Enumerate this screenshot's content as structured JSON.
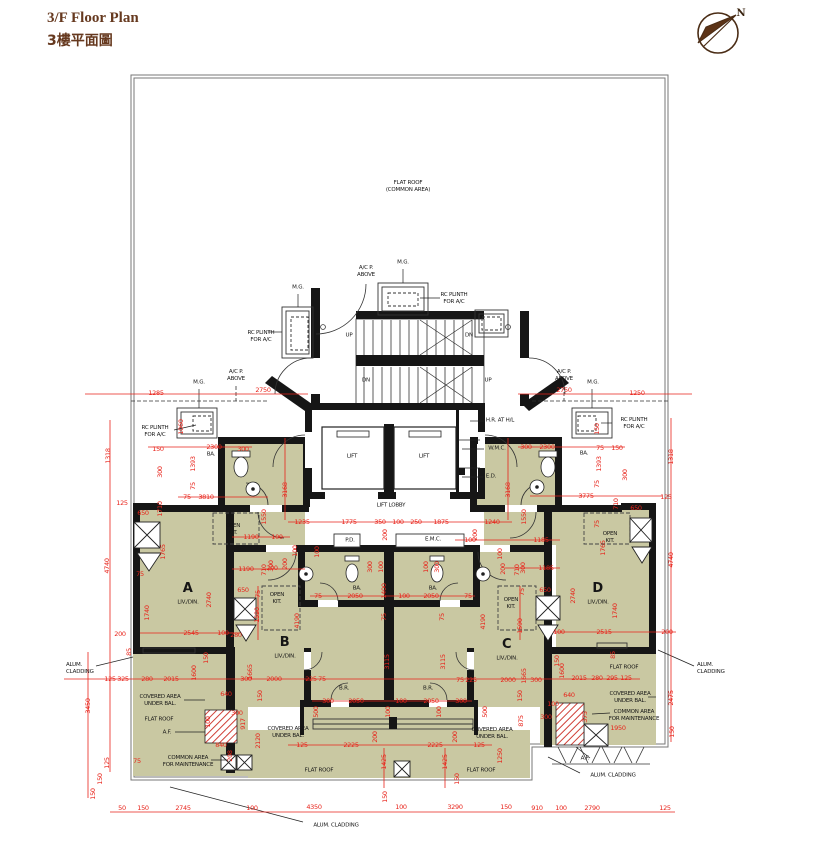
{
  "title": {
    "line1": "3/F Floor Plan",
    "line2": "3樓平面圖"
  },
  "compass": {
    "label": "N"
  },
  "colors": {
    "flat_fill": "#c9c8a2",
    "wall": "#161616",
    "dim_red": "#e8231a",
    "title_brown": "#66391f",
    "boundary_gray": "#777777"
  },
  "plan": {
    "labels": [
      {
        "t": "FLAT ROOF\n(COMMON AREA)",
        "x": 408,
        "y": 187,
        "n": "flat-roof-common-area-label"
      },
      {
        "t": "M.G.",
        "x": 403,
        "y": 263,
        "n": "mg-label"
      },
      {
        "t": "A/C P.\nABOVE",
        "x": 366,
        "y": 272,
        "n": "ac-platform-label"
      },
      {
        "t": "M.G.",
        "x": 298,
        "y": 288,
        "n": "mg-label"
      },
      {
        "t": "RC PLINTH\nFOR A/C",
        "x": 454,
        "y": 299,
        "n": "rc-plinth-label"
      },
      {
        "t": "RC PLINTH\nFOR A/C",
        "x": 261,
        "y": 337,
        "n": "rc-plinth-label"
      },
      {
        "t": "UP",
        "x": 349,
        "y": 336,
        "n": "stair-up-label"
      },
      {
        "t": "DN",
        "x": 469,
        "y": 336,
        "n": "stair-dn-label"
      },
      {
        "t": "DN",
        "x": 366,
        "y": 381,
        "n": "stair-dn-label"
      },
      {
        "t": "UP",
        "x": 488,
        "y": 381,
        "n": "stair-up-label"
      },
      {
        "t": "M.G.",
        "x": 199,
        "y": 383,
        "n": "mg-label"
      },
      {
        "t": "A/C P.\nABOVE",
        "x": 236,
        "y": 376,
        "n": "ac-platform-label"
      },
      {
        "t": "A/C P.\nABOVE",
        "x": 564,
        "y": 376,
        "n": "ac-platform-label"
      },
      {
        "t": "M.G.",
        "x": 593,
        "y": 383,
        "n": "mg-label"
      },
      {
        "t": "RC PLINTH\nFOR A/C",
        "x": 155,
        "y": 432,
        "n": "rc-plinth-label"
      },
      {
        "t": "RC PLINTH\nFOR A/C",
        "x": 634,
        "y": 424,
        "n": "rc-plinth-label"
      },
      {
        "t": "LIFT",
        "x": 352,
        "y": 457,
        "n": "lift-label"
      },
      {
        "t": "LIFT",
        "x": 424,
        "y": 457,
        "n": "lift-label"
      },
      {
        "t": "H.R. AT H/L",
        "x": 500,
        "y": 421,
        "n": "hose-reel-label"
      },
      {
        "t": "W.M.C.",
        "x": 497,
        "y": 449,
        "n": "wmc-label"
      },
      {
        "t": "E.D.",
        "x": 491,
        "y": 477,
        "n": "ed-label"
      },
      {
        "t": "LIFT LOBBY",
        "x": 391,
        "y": 506,
        "n": "lift-lobby-label"
      },
      {
        "t": "BA.",
        "x": 211,
        "y": 455,
        "n": "bathroom-label"
      },
      {
        "t": "BA.",
        "x": 584,
        "y": 454,
        "n": "bathroom-label"
      },
      {
        "t": "P.D.",
        "x": 350,
        "y": 541,
        "n": "pd-label"
      },
      {
        "t": "E.M.C.",
        "x": 433,
        "y": 540,
        "n": "emc-label"
      },
      {
        "t": "BA.",
        "x": 357,
        "y": 589,
        "n": "bathroom-label"
      },
      {
        "t": "BA.",
        "x": 433,
        "y": 589,
        "n": "bathroom-label"
      },
      {
        "t": "OPEN\nKIT.",
        "x": 233,
        "y": 530,
        "n": "open-kitchen-label"
      },
      {
        "t": "OPEN\nKIT.",
        "x": 277,
        "y": 599,
        "n": "open-kitchen-label"
      },
      {
        "t": "OPEN\nKIT.",
        "x": 511,
        "y": 604,
        "n": "open-kitchen-label"
      },
      {
        "t": "OPEN\nKIT.",
        "x": 610,
        "y": 538,
        "n": "open-kitchen-label"
      },
      {
        "t": "B.R.",
        "x": 344,
        "y": 689,
        "n": "bedroom-label"
      },
      {
        "t": "B.R.",
        "x": 428,
        "y": 689,
        "n": "bedroom-label"
      },
      {
        "t": "COVERED AREA\nUNDER BAL.",
        "x": 160,
        "y": 701,
        "n": "covered-area-label"
      },
      {
        "t": "COVERED AREA\nUNDER BAL.",
        "x": 288,
        "y": 733,
        "n": "covered-area-label"
      },
      {
        "t": "COVERED AREA\nUNDER BAL.",
        "x": 492,
        "y": 734,
        "n": "covered-area-label"
      },
      {
        "t": "COVERED AREA\nUNDER BAL.",
        "x": 630,
        "y": 698,
        "n": "covered-area-label"
      },
      {
        "t": "FLAT ROOF",
        "x": 159,
        "y": 720,
        "n": "flat-roof-label"
      },
      {
        "t": "FLAT ROOF",
        "x": 319,
        "y": 771,
        "n": "flat-roof-label"
      },
      {
        "t": "FLAT ROOF",
        "x": 481,
        "y": 771,
        "n": "flat-roof-label"
      },
      {
        "t": "FLAT ROOF",
        "x": 624,
        "y": 668,
        "n": "flat-roof-label"
      },
      {
        "t": "A.F.",
        "x": 167,
        "y": 733,
        "n": "af-label"
      },
      {
        "t": "A.F.",
        "x": 585,
        "y": 759,
        "n": "af-label"
      },
      {
        "t": "COMMON AREA\nFOR MAINTENANCE",
        "x": 188,
        "y": 762,
        "n": "common-area-label"
      },
      {
        "t": "COMMON AREA\nFOR MAINTENANCE",
        "x": 634,
        "y": 716,
        "n": "common-area-label"
      },
      {
        "t": "ALUM.\nCLADDING",
        "x": 66,
        "y": 669,
        "cls": "left",
        "n": "alum-cladding-label"
      },
      {
        "t": "ALUM.\nCLADDING",
        "x": 697,
        "y": 669,
        "cls": "left",
        "n": "alum-cladding-label"
      },
      {
        "t": "ALUM. CLADDING",
        "x": 336,
        "y": 826,
        "n": "alum-cladding-label"
      },
      {
        "t": "ALUM. CLADDING",
        "x": 613,
        "y": 776,
        "n": "alum-cladding-label"
      },
      {
        "t": "A",
        "x": 188,
        "y": 589,
        "cls": "flat",
        "n": "flat-a-label"
      },
      {
        "t": "LIV./DIN.",
        "x": 188,
        "y": 603,
        "n": "living-dining-label"
      },
      {
        "t": "B",
        "x": 285,
        "y": 643,
        "cls": "flat",
        "n": "flat-b-label"
      },
      {
        "t": "LIV./DIN.",
        "x": 285,
        "y": 657,
        "n": "living-dining-label"
      },
      {
        "t": "C",
        "x": 507,
        "y": 645,
        "cls": "flat",
        "n": "flat-c-label"
      },
      {
        "t": "LIV./DIN.",
        "x": 507,
        "y": 659,
        "n": "living-dining-label"
      },
      {
        "t": "D",
        "x": 598,
        "y": 589,
        "cls": "flat",
        "n": "flat-d-label"
      },
      {
        "t": "LIV./DIN.",
        "x": 598,
        "y": 603,
        "n": "living-dining-label"
      },
      {
        "t": "N",
        "x": 741,
        "y": 14,
        "cls": "north",
        "n": "north-label"
      }
    ],
    "dims": [
      [
        "1285",
        156,
        393
      ],
      [
        "2750",
        263,
        390
      ],
      [
        "2750",
        564,
        390
      ],
      [
        "1250",
        637,
        393
      ],
      [
        "1318",
        108,
        456,
        1
      ],
      [
        "4740",
        107,
        566,
        1
      ],
      [
        "3450",
        88,
        706,
        1
      ],
      [
        "125",
        107,
        763,
        1
      ],
      [
        "150",
        100,
        779,
        1
      ],
      [
        "150",
        93,
        794,
        1
      ],
      [
        "150",
        158,
        449
      ],
      [
        "2300",
        214,
        447
      ],
      [
        "300",
        243,
        449
      ],
      [
        "1060",
        181,
        427,
        1
      ],
      [
        "1393",
        193,
        464,
        1
      ],
      [
        "75",
        193,
        486,
        1
      ],
      [
        "300",
        160,
        472,
        1
      ],
      [
        "125",
        122,
        503
      ],
      [
        "650",
        143,
        513
      ],
      [
        "75",
        187,
        497
      ],
      [
        "3810",
        206,
        497
      ],
      [
        "1710",
        160,
        509,
        1
      ],
      [
        "1765",
        163,
        552,
        1
      ],
      [
        "75",
        140,
        574
      ],
      [
        "2740",
        209,
        600,
        1
      ],
      [
        "1740",
        147,
        613,
        1
      ],
      [
        "1550",
        264,
        517,
        1
      ],
      [
        "1190",
        251,
        537
      ],
      [
        "100",
        277,
        537
      ],
      [
        "1190",
        246,
        569
      ],
      [
        "200",
        272,
        568
      ],
      [
        "710",
        264,
        570,
        1
      ],
      [
        "300",
        271,
        566,
        1
      ],
      [
        "200",
        285,
        564,
        1
      ],
      [
        "100",
        295,
        551,
        1
      ],
      [
        "650",
        243,
        590
      ],
      [
        "75",
        258,
        594,
        1
      ],
      [
        "1590",
        257,
        615,
        1
      ],
      [
        "280",
        236,
        635
      ],
      [
        "4190",
        297,
        621,
        1
      ],
      [
        "200",
        120,
        634
      ],
      [
        "2545",
        191,
        633
      ],
      [
        "100",
        223,
        633
      ],
      [
        "125",
        110,
        679
      ],
      [
        "325",
        123,
        679
      ],
      [
        "280",
        147,
        679
      ],
      [
        "2015",
        171,
        679
      ],
      [
        "1600",
        194,
        673,
        1
      ],
      [
        "150",
        206,
        658,
        1
      ],
      [
        "85",
        129,
        652,
        1
      ],
      [
        "300",
        246,
        679
      ],
      [
        "2000",
        274,
        679
      ],
      [
        "225",
        311,
        679
      ],
      [
        "75",
        322,
        679
      ],
      [
        "1665",
        250,
        672,
        1
      ],
      [
        "150",
        260,
        696,
        1
      ],
      [
        "640",
        226,
        694
      ],
      [
        "100",
        208,
        722,
        1
      ],
      [
        "917",
        243,
        724,
        1
      ],
      [
        "300",
        237,
        713
      ],
      [
        "840",
        221,
        745
      ],
      [
        "208",
        230,
        756,
        1
      ],
      [
        "2120",
        258,
        741,
        1
      ],
      [
        "75",
        137,
        761
      ],
      [
        "1235",
        302,
        522
      ],
      [
        "1775",
        349,
        522
      ],
      [
        "350",
        380,
        522
      ],
      [
        "100",
        398,
        522
      ],
      [
        "250",
        416,
        522
      ],
      [
        "1875",
        441,
        522
      ],
      [
        "1240",
        492,
        522
      ],
      [
        "3168",
        285,
        490,
        1
      ],
      [
        "3168",
        508,
        490,
        1
      ],
      [
        "200",
        385,
        535,
        1
      ],
      [
        "200",
        475,
        535,
        1
      ],
      [
        "100",
        317,
        552,
        1
      ],
      [
        "100",
        500,
        554,
        1
      ],
      [
        "300",
        370,
        567,
        1
      ],
      [
        "100",
        381,
        567,
        1
      ],
      [
        "100",
        426,
        567,
        1
      ],
      [
        "300",
        437,
        567,
        1
      ],
      [
        "75",
        318,
        596
      ],
      [
        "2050",
        355,
        596
      ],
      [
        "1400",
        384,
        591,
        1
      ],
      [
        "100",
        404,
        596
      ],
      [
        "2050",
        431,
        596
      ],
      [
        "75",
        468,
        596
      ],
      [
        "75",
        384,
        617,
        1
      ],
      [
        "75",
        442,
        617,
        1
      ],
      [
        "3115",
        387,
        662,
        1
      ],
      [
        "3115",
        443,
        662,
        1
      ],
      [
        "2000",
        508,
        680
      ],
      [
        "225",
        471,
        680
      ],
      [
        "75",
        460,
        680
      ],
      [
        "1665",
        524,
        676,
        1
      ],
      [
        "150",
        520,
        696,
        1
      ],
      [
        "300",
        328,
        701
      ],
      [
        "2050",
        356,
        701
      ],
      [
        "100",
        401,
        701
      ],
      [
        "2050",
        431,
        701
      ],
      [
        "300",
        461,
        701
      ],
      [
        "500",
        316,
        712,
        1
      ],
      [
        "100",
        388,
        712,
        1
      ],
      [
        "100",
        439,
        712,
        1
      ],
      [
        "500",
        485,
        712,
        1
      ],
      [
        "200",
        375,
        737,
        1
      ],
      [
        "200",
        455,
        737,
        1
      ],
      [
        "125",
        302,
        745
      ],
      [
        "2225",
        351,
        745
      ],
      [
        "2225",
        435,
        745
      ],
      [
        "125",
        479,
        745
      ],
      [
        "1425",
        384,
        762,
        1
      ],
      [
        "1425",
        445,
        762,
        1
      ],
      [
        "150",
        385,
        797,
        1
      ],
      [
        "150",
        457,
        779,
        1
      ],
      [
        "875",
        521,
        721,
        1
      ],
      [
        "1250",
        500,
        756,
        1
      ],
      [
        "50",
        122,
        808
      ],
      [
        "150",
        143,
        808
      ],
      [
        "2745",
        183,
        808
      ],
      [
        "100",
        252,
        808
      ],
      [
        "4350",
        314,
        807
      ],
      [
        "100",
        401,
        807
      ],
      [
        "3290",
        455,
        807
      ],
      [
        "150",
        506,
        807
      ],
      [
        "910",
        537,
        808
      ],
      [
        "100",
        561,
        808
      ],
      [
        "2790",
        592,
        808
      ],
      [
        "125",
        665,
        808
      ],
      [
        "100",
        470,
        540
      ],
      [
        "1185",
        541,
        540
      ],
      [
        "1185",
        546,
        568
      ],
      [
        "710",
        517,
        570,
        1
      ],
      [
        "300",
        523,
        568,
        1
      ],
      [
        "200",
        503,
        569,
        1
      ],
      [
        "650",
        545,
        590
      ],
      [
        "75",
        522,
        592,
        1
      ],
      [
        "1590",
        520,
        626,
        1
      ],
      [
        "4190",
        483,
        622,
        1
      ],
      [
        "2740",
        573,
        596,
        1
      ],
      [
        "1740",
        615,
        611,
        1
      ],
      [
        "100",
        559,
        632
      ],
      [
        "2515",
        604,
        632
      ],
      [
        "200",
        667,
        632
      ],
      [
        "2015",
        579,
        678
      ],
      [
        "280",
        597,
        678
      ],
      [
        "295",
        612,
        678
      ],
      [
        "125",
        626,
        678
      ],
      [
        "300",
        536,
        680
      ],
      [
        "1600",
        562,
        671,
        1
      ],
      [
        "150",
        557,
        661,
        1
      ],
      [
        "85",
        613,
        655,
        1
      ],
      [
        "640",
        569,
        695
      ],
      [
        "375",
        585,
        717,
        1
      ],
      [
        "1950",
        618,
        728
      ],
      [
        "100",
        553,
        704
      ],
      [
        "300",
        546,
        717
      ],
      [
        "2475",
        671,
        698,
        1
      ],
      [
        "150",
        672,
        732,
        1
      ],
      [
        "125",
        666,
        497
      ],
      [
        "4740",
        671,
        560,
        1
      ],
      [
        "1318",
        671,
        457,
        1
      ],
      [
        "150",
        597,
        429,
        1
      ],
      [
        "300",
        526,
        447
      ],
      [
        "2300",
        547,
        447
      ],
      [
        "75",
        600,
        448
      ],
      [
        "150",
        617,
        448
      ],
      [
        "1393",
        599,
        464,
        1
      ],
      [
        "75",
        597,
        484,
        1
      ],
      [
        "300",
        625,
        475,
        1
      ],
      [
        "3775",
        586,
        496
      ],
      [
        "710",
        616,
        504,
        1
      ],
      [
        "650",
        636,
        508
      ],
      [
        "75",
        597,
        524,
        1
      ],
      [
        "1765",
        603,
        548,
        1
      ],
      [
        "1550",
        524,
        517,
        1
      ]
    ]
  }
}
